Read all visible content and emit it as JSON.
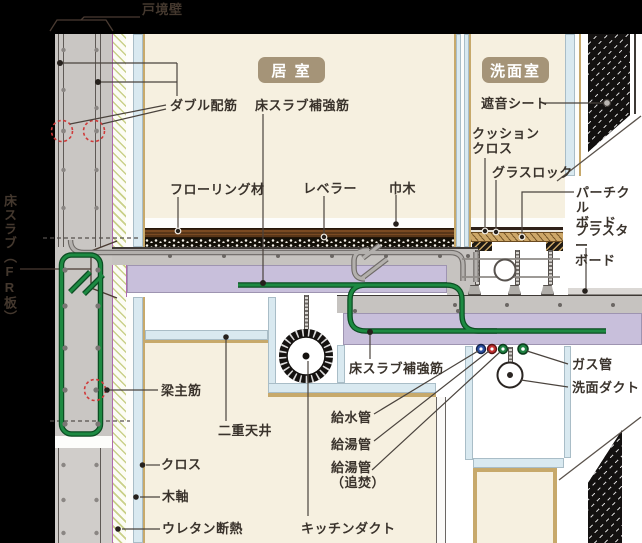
{
  "rooms": {
    "living": {
      "label": "居 室"
    },
    "washroom": {
      "label": "洗面室"
    }
  },
  "labels": {
    "tosakai": {
      "text": "戸境壁"
    },
    "fr_slab": {
      "text": "床スラブ（FR板）"
    },
    "double_rebar": {
      "text": "ダブル配筋"
    },
    "slab_rebar_top": {
      "text": "床スラブ補強筋"
    },
    "slab_rebar_bottom": {
      "text": "床スラブ補強筋"
    },
    "flooring": {
      "text": "フローリング材"
    },
    "leveler": {
      "text": "レベラー"
    },
    "habaki": {
      "text": "巾木"
    },
    "shaon_sheet": {
      "text": "遮音シート"
    },
    "cushion_cloth": {
      "text": "クッション\nクロス"
    },
    "glass_rock": {
      "text": "グラスロック"
    },
    "particle_board": {
      "text": "パーチクル\nボード"
    },
    "plaster_board": {
      "text": "プラスター\nボード"
    },
    "hari_shukin": {
      "text": "梁主筋"
    },
    "niju_tenjo": {
      "text": "二重天井"
    },
    "kyusui": {
      "text": "給水管"
    },
    "kyuto": {
      "text": "給湯管"
    },
    "kyuto_oidaki": {
      "text": "給湯管\n（追焚）"
    },
    "gas_pipe": {
      "text": "ガス管"
    },
    "senmen_duct": {
      "text": "洗面ダクト"
    },
    "cross": {
      "text": "クロス"
    },
    "mokujiku": {
      "text": "木軸"
    },
    "urethane": {
      "text": "ウレタン断熱"
    },
    "kitchen_duct": {
      "text": "キッチンダクト"
    }
  },
  "colors": {
    "background": "#000000",
    "room_cream": "#f6f0e0",
    "concrete_gray": "#c9c6c3",
    "slab_purple": "#c8bfdb",
    "board_blue": "#d9e9f0",
    "wood_tan": "#c7a96b",
    "rebar_green": "#157a38",
    "badge_bg": "#a59478",
    "label_text": "#3a332c",
    "pipe_blue": "#2b4ea0",
    "pipe_red": "#c32f2f",
    "pipe_green": "#1d8040",
    "dashed_circle_red": "#d03a3a"
  }
}
